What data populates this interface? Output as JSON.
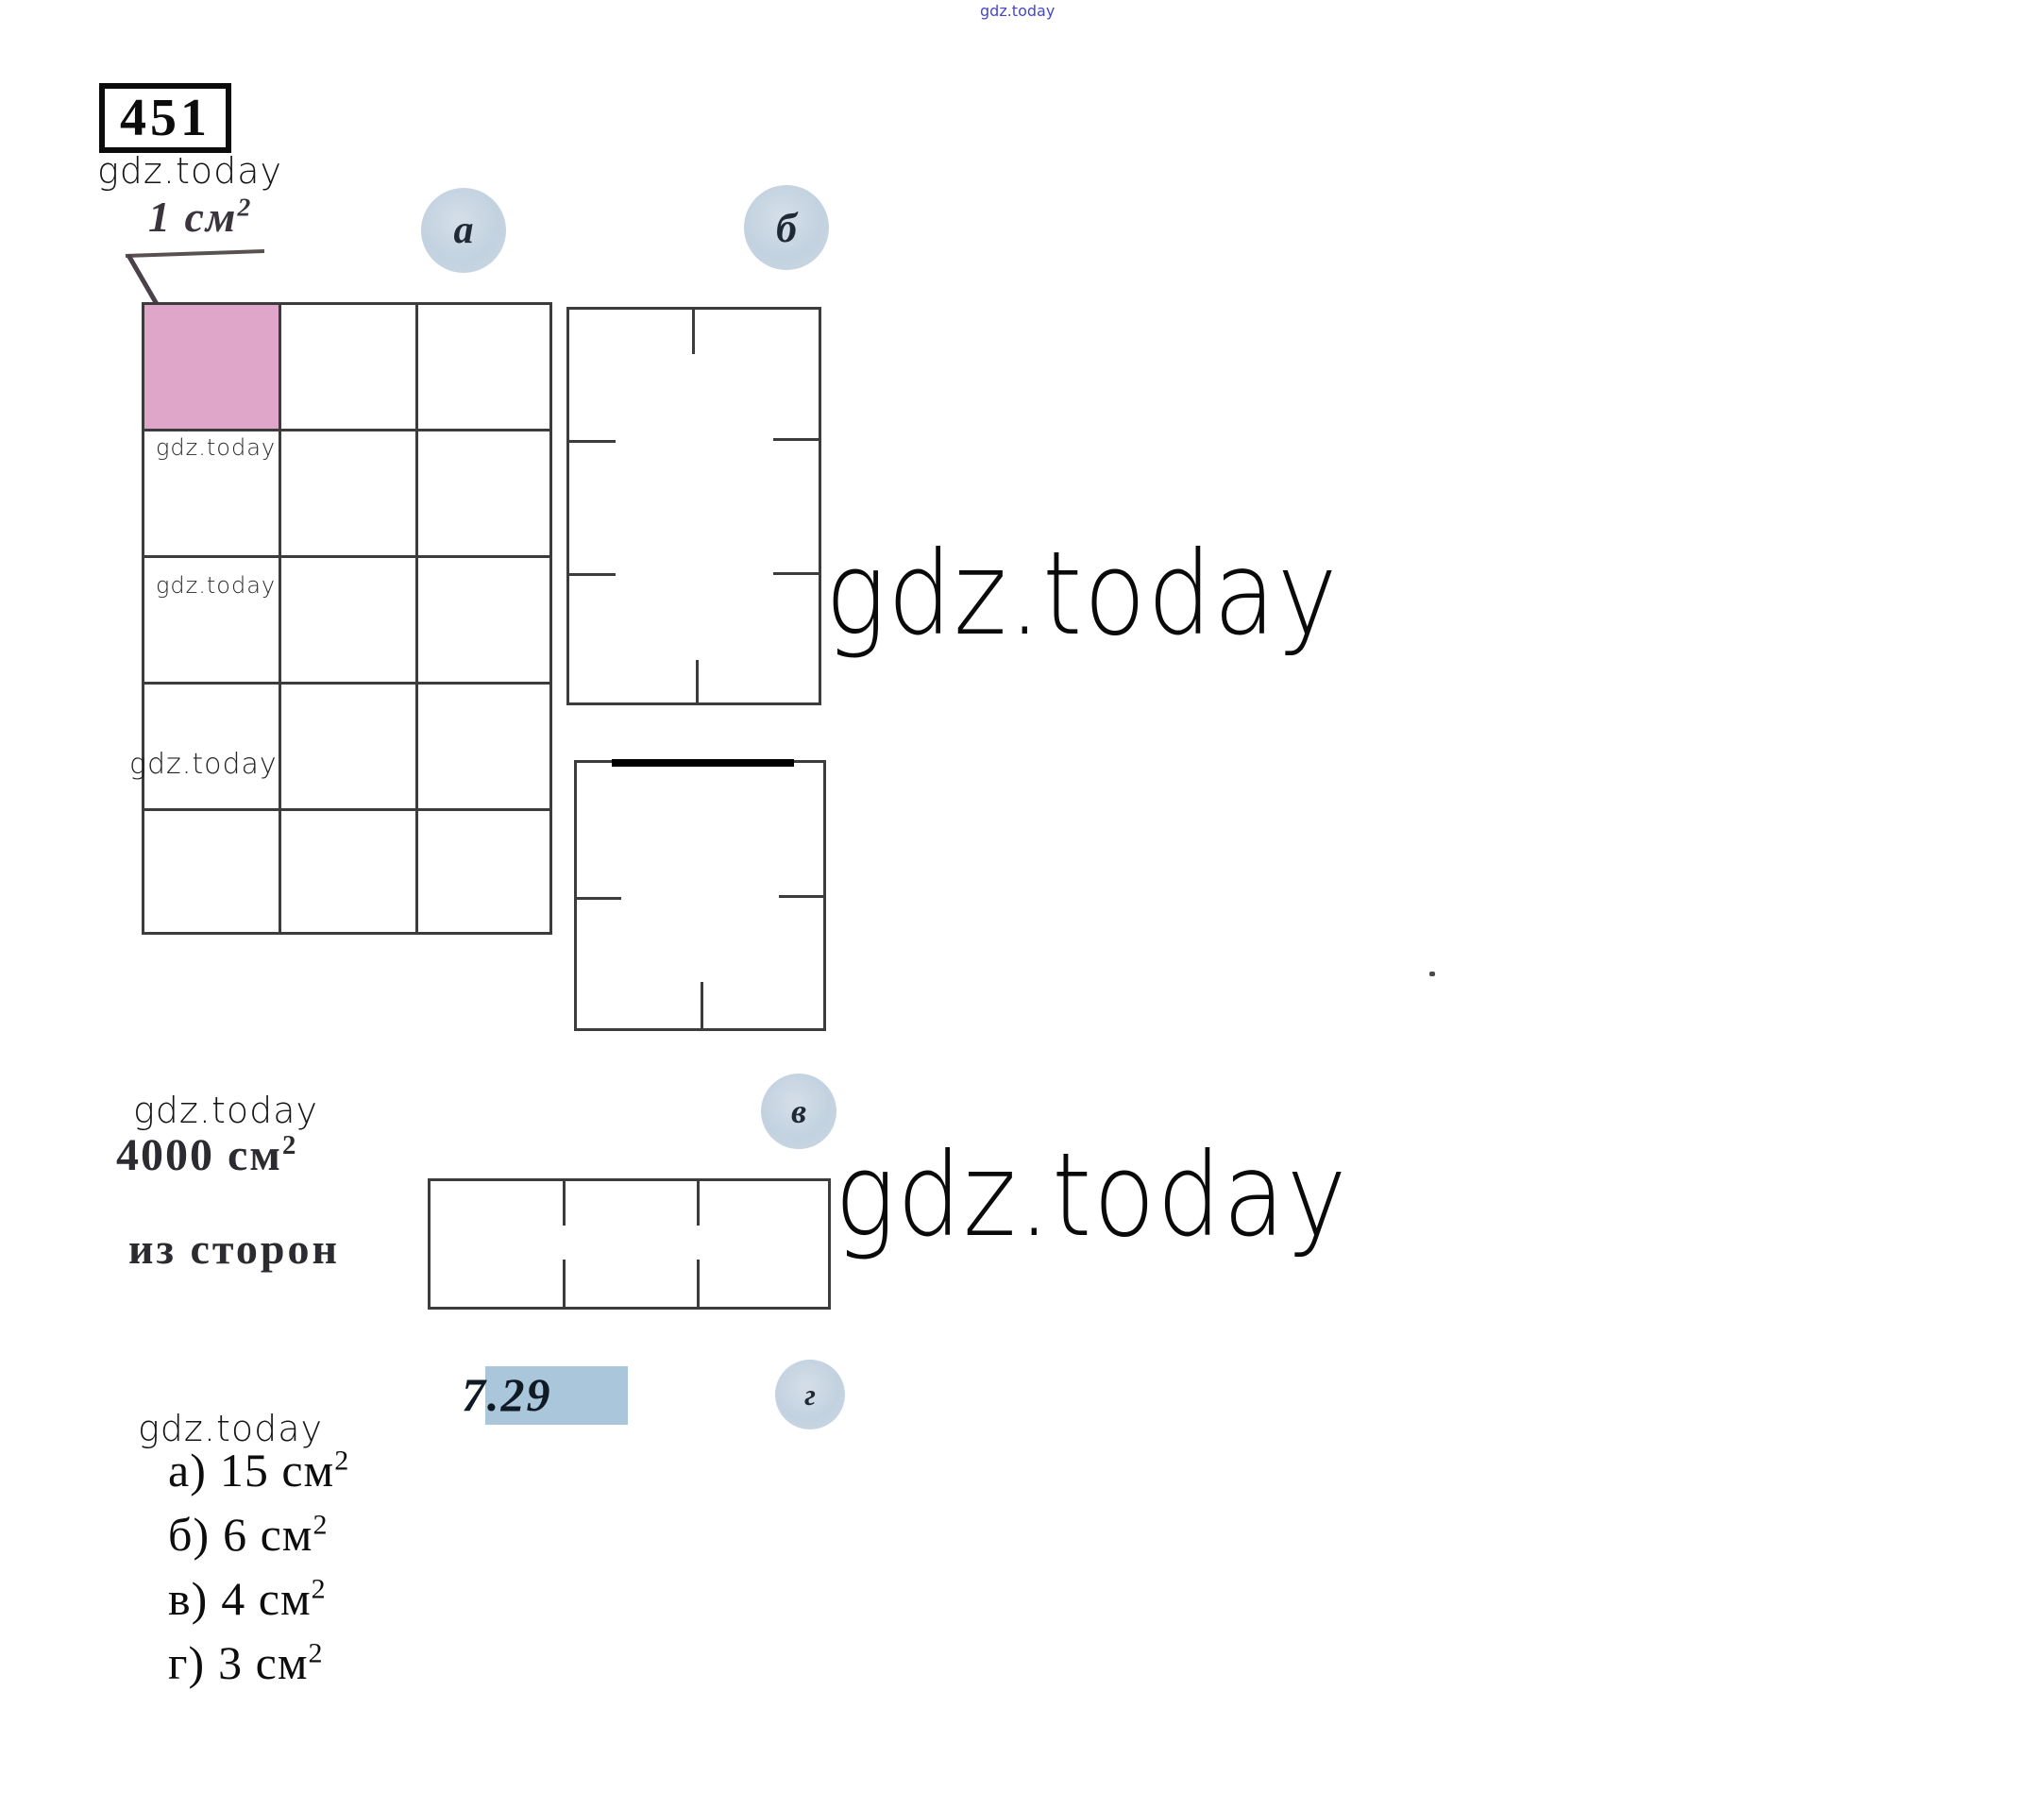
{
  "watermarks": {
    "brand": "gdz.today",
    "brand_color_top": "#4545d5",
    "brand_color_main": "#0a0a0a"
  },
  "problem": {
    "number": "451",
    "unit_value": "1 см",
    "unit_exp": "2",
    "area_value": "4000 см",
    "area_exp": "2",
    "sides_text": "из сторон",
    "figure_number": "7.29"
  },
  "figure_labels": {
    "a": "а",
    "b": "б",
    "v": "в",
    "g": "г"
  },
  "figures": {
    "grid_a": {
      "columns": 3,
      "rows": 5,
      "shaded_cell": "top-left",
      "area_cm2": 15
    },
    "rect_b": {
      "columns": 2,
      "rows": 3,
      "area_cm2": 6
    },
    "square_v": {
      "columns": 2,
      "rows": 2,
      "area_cm2": 4
    },
    "rect_g": {
      "columns": 3,
      "rows": 1,
      "area_cm2": 3
    }
  },
  "answers": {
    "items": [
      {
        "label": "а)",
        "value": "15 см",
        "exp": "2"
      },
      {
        "label": "б)",
        "value": "6 см",
        "exp": "2"
      },
      {
        "label": "в)",
        "value": "4 см",
        "exp": "2"
      },
      {
        "label": "г)",
        "value": "3 см",
        "exp": "2"
      }
    ]
  },
  "colors": {
    "pink_cell": "#dfa6ca",
    "grid_line": "#3c3c3c",
    "circle_fill": "#c7d5e1",
    "circle_text": "#1f2a36",
    "highlight_729": "#a9c6da",
    "page_bg": "#ffffff"
  }
}
